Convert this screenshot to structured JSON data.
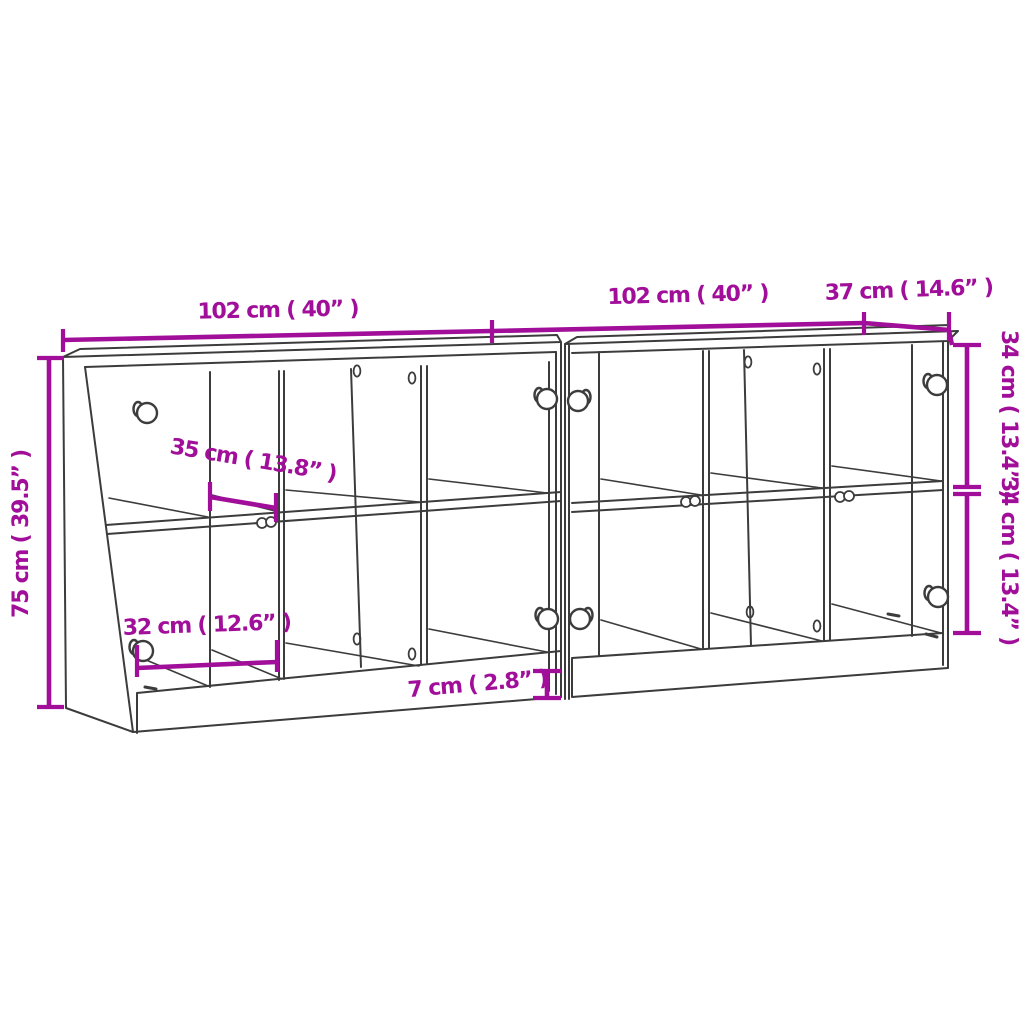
{
  "meta": {
    "description": "Two-unit bookcase / sideboard with glass doors — dimension diagram",
    "units_count": 2
  },
  "colors": {
    "dimension_accent": "#a10e99",
    "drawing_line": "#3c3c3c",
    "background": "#ffffff"
  },
  "dims": {
    "left_width": {
      "label": "102 cm ( 40” )"
    },
    "right_width": {
      "label": "102 cm ( 40” )"
    },
    "depth": {
      "label": "37 cm ( 14.6” )"
    },
    "height": {
      "label": "75 cm ( 39.5” )"
    },
    "upper_compartment_height": {
      "label": "34 cm ( 13.4” )"
    },
    "lower_compartment_height": {
      "label": "34 cm ( 13.4” )"
    },
    "shelf_depth": {
      "label": "35 cm ( 13.8” )"
    },
    "compartment_width": {
      "label": "32 cm ( 12.6” )"
    },
    "plinth_height": {
      "label": "7 cm ( 2.8” )"
    }
  }
}
